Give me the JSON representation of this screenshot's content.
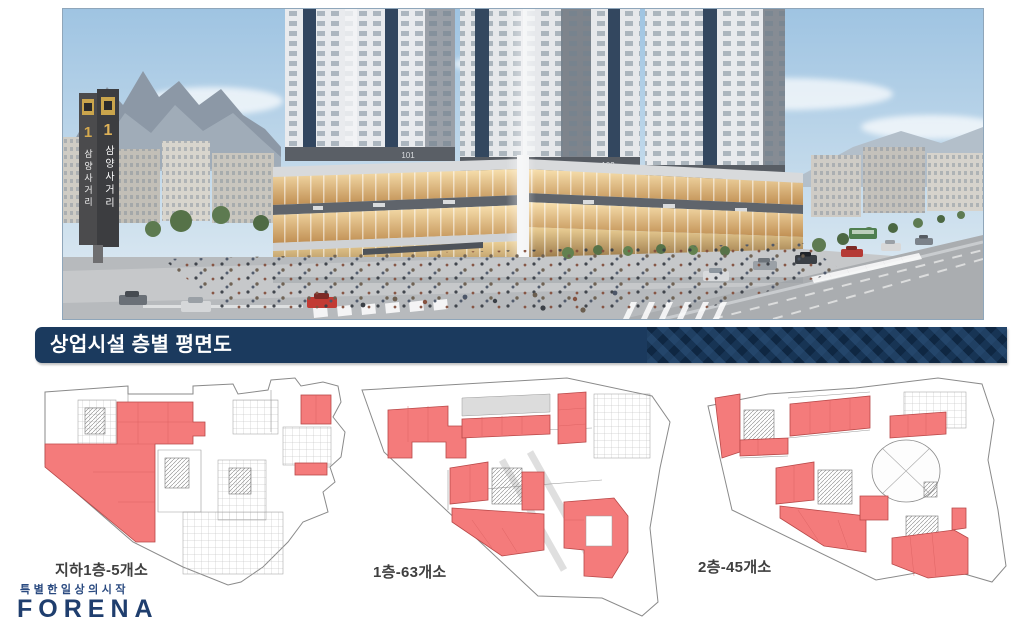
{
  "hero": {
    "tower_labels": [
      "101",
      "102",
      "103"
    ],
    "signpost": {
      "badge_number": "1",
      "name": "삼양사거리"
    }
  },
  "banner": {
    "title": "상업시설 층별 평면도"
  },
  "plans": [
    {
      "label": "지하1층-5개소"
    },
    {
      "label": "1층-63개소"
    },
    {
      "label": "2층-45개소"
    }
  ],
  "footer": {
    "tagline": "특별한일상의시작",
    "brand": "FORENA"
  },
  "colors": {
    "banner_navy": "#1b3a5e",
    "plan_highlight": "#f47b7b",
    "brand_navy": "#1f3e6e"
  }
}
